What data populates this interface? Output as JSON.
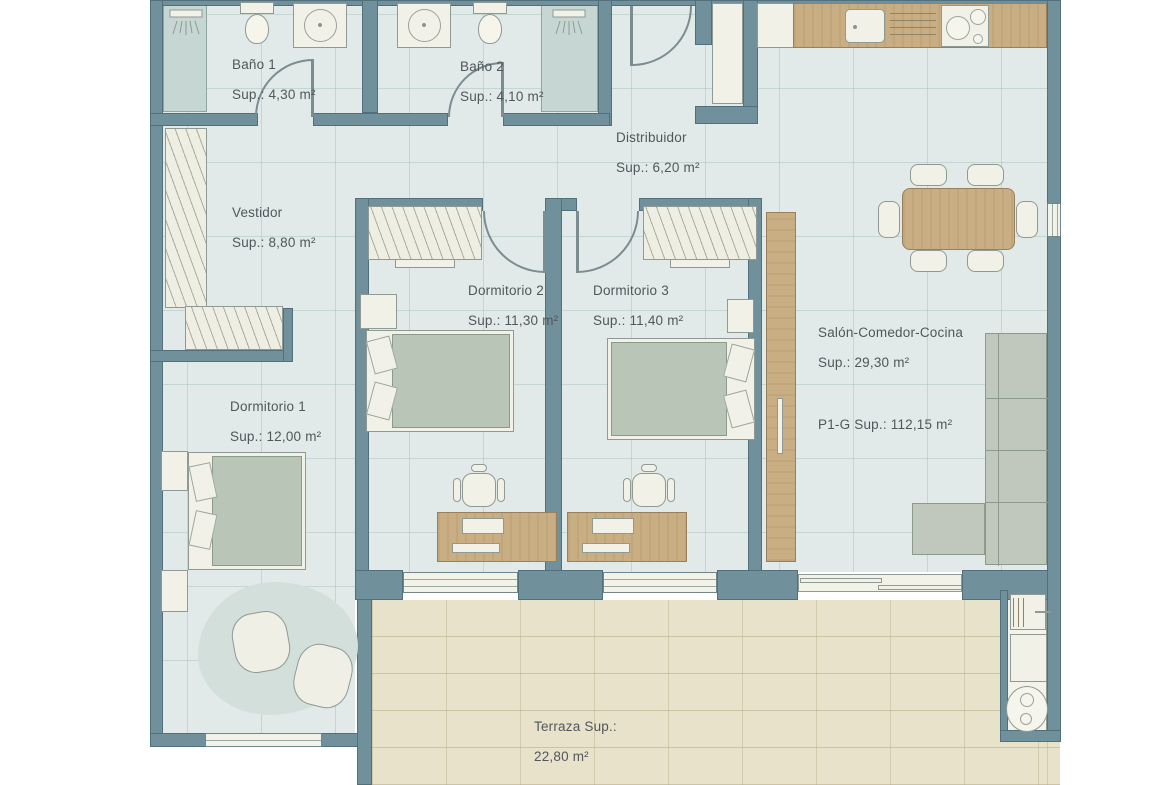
{
  "plan": {
    "rooms": {
      "bano1": {
        "name": "Baño 1",
        "area": "Sup.: 4,30 m²"
      },
      "bano2": {
        "name": "Baño 2",
        "area": "Sup.: 4,10 m²"
      },
      "distribuidor": {
        "name": "Distribuidor",
        "area": "Sup.: 6,20 m²"
      },
      "vestidor": {
        "name": "Vestidor",
        "area": "Sup.: 8,80 m²"
      },
      "dormitorio1": {
        "name": "Dormitorio 1",
        "area": "Sup.: 12,00 m²"
      },
      "dormitorio2": {
        "name": "Dormitorio 2",
        "area": "Sup.: 11,30 m²"
      },
      "dormitorio3": {
        "name": "Dormitorio 3",
        "area": "Sup.: 11,40 m²"
      },
      "salon": {
        "name": "Salón-Comedor-Cocina",
        "area": "Sup.: 29,30 m²"
      },
      "terraza": {
        "name": "Terraza Sup.:",
        "area": "22,80 m²"
      }
    },
    "total": {
      "label": "P1-G Sup.: 112,15 m²"
    },
    "colors": {
      "wall": "#70909b",
      "floor_tile": "#e1eae8",
      "terrace_floor": "#e8e2cb",
      "wood": "#c9ae83",
      "wet_zone": "#c6d7d3",
      "fixture_white": "#f2f1e8",
      "upholstery_green": "#b9c5b6",
      "label_text": "#50575a"
    }
  }
}
